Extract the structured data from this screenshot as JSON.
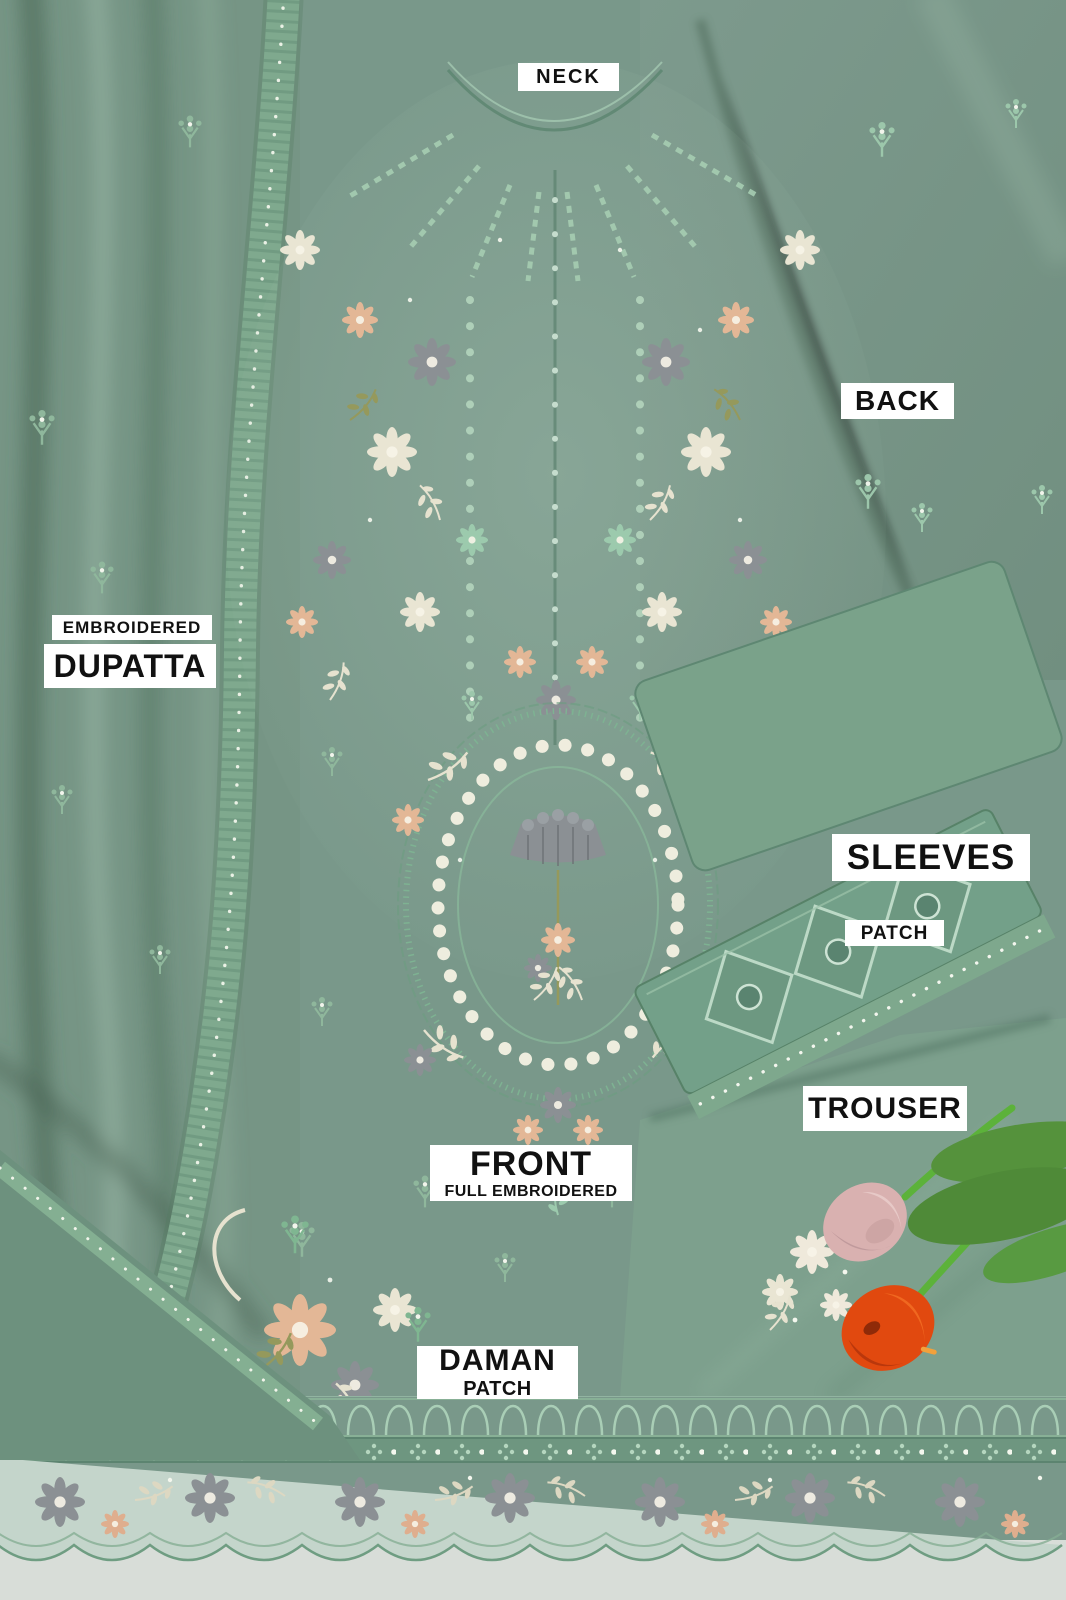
{
  "photo": {
    "labels": {
      "neck": "NECK",
      "back": "BACK",
      "dupatta_top": "EMBROIDERED",
      "dupatta_main": "DUPATTA",
      "sleeves": "SLEEVES",
      "sleeves_sub": "PATCH",
      "trouser": "TROUSER",
      "front_main": "FRONT",
      "front_sub": "FULL EMBROIDERED",
      "daman_main": "DAMAN",
      "daman_sub": "PATCH"
    },
    "colors": {
      "fabric_base": "#79988a",
      "fabric_shadow": "#50705f",
      "fabric_highlight": "#9fbcab",
      "embroidery_cream": "#e9e5d3",
      "embroidery_gray": "#8b9094",
      "embroidery_peach": "#e3b796",
      "embroidery_green": "#9ccaad",
      "sheer_hem": "#c4d5cb",
      "floor": "#d8ddd8",
      "label_bg": "#ffffff",
      "label_text": "#111111",
      "tulip_orange": "#e1490f",
      "tulip_pink": "#d9b1b0",
      "leaf_green": "#55923c",
      "stem_green": "#5cb23a"
    }
  }
}
